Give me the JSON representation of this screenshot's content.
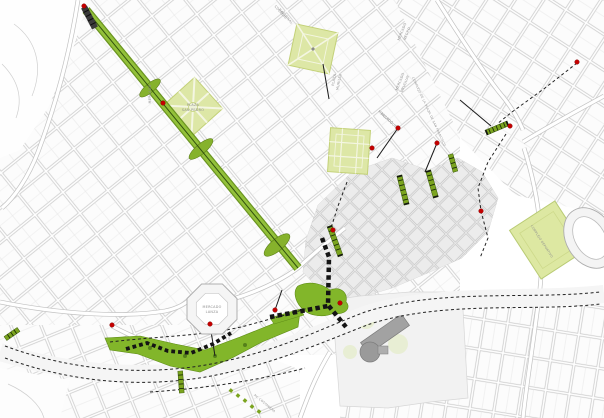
{
  "map": {
    "labels": [
      {
        "text": "MERCADO"
      },
      {
        "text": "PLAZA"
      },
      {
        "text": "SAN PEDRO"
      },
      {
        "text": "COLEGIO"
      },
      {
        "text": "NACIONAL"
      },
      {
        "text": "PLAZA"
      },
      {
        "text": "MURILLO"
      },
      {
        "text": "MERCADO"
      },
      {
        "text": "NEGRO"
      },
      {
        "text": "MERCADO"
      },
      {
        "text": "URUGUAY"
      },
      {
        "text": "MERCADO"
      },
      {
        "text": "RODRIGUEZ"
      },
      {
        "text": "COMPLEJO DE LA PLAZA DE SAN FRANCISCO"
      },
      {
        "text": "MERCADO"
      },
      {
        "text": "LANZA"
      },
      {
        "text": "COMPLEJO DEPORTIVO"
      },
      {
        "text": "AV. COSTANERA"
      }
    ],
    "colors": {
      "avenue_green": "#8fbe2e",
      "avenue_edge": "#6a9420",
      "park_fill": "#dde7a6",
      "park_stroke": "#c3d178",
      "corridor_green": "#82b62a",
      "stair_green": "#7ba41f",
      "marker_red": "#c40000",
      "route_black": "#1a1a1a",
      "fabric_gray": "#c9c9c9",
      "oldtown_gray": "#e9e9e9"
    }
  }
}
